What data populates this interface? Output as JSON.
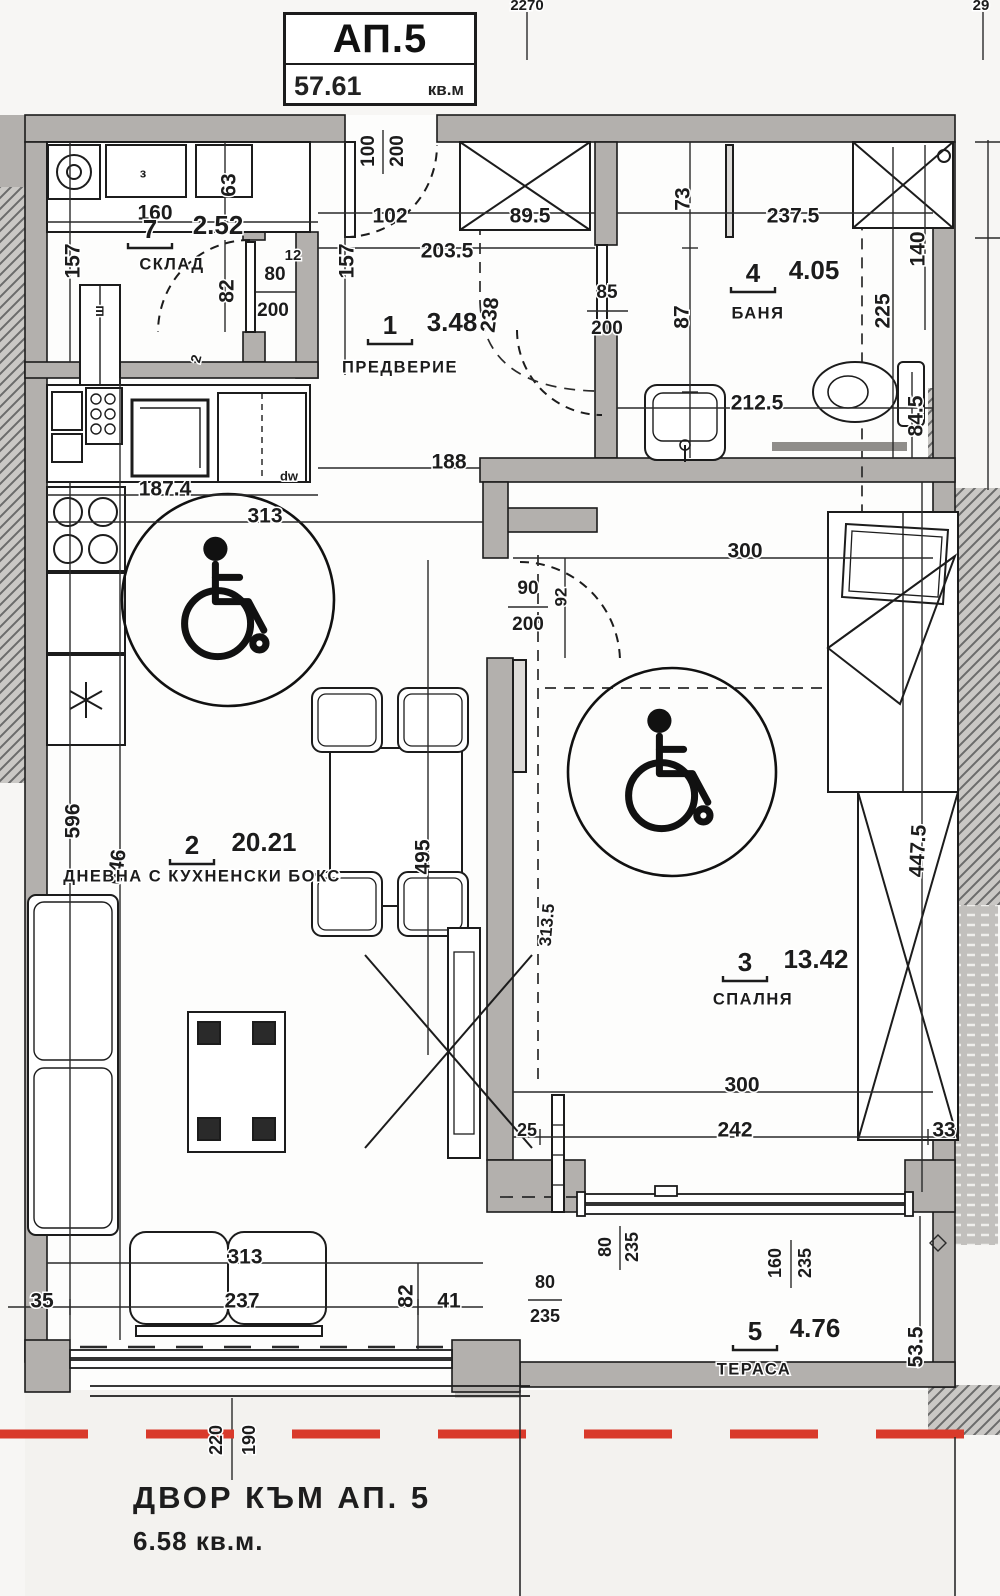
{
  "title_block": {
    "apartment": "АП.5",
    "area_value": "57.61",
    "area_unit": "кв.м"
  },
  "yard": {
    "line1": "ДВОР  КЪМ АП. 5",
    "line2": "6.58 кв.м."
  },
  "colors": {
    "wall": "#b3b0ad",
    "line": "#1c1c1c",
    "red_dashed": "#d93a2b",
    "hatch": "#6b6b6b"
  },
  "rooms": [
    {
      "num": "7",
      "area": "2.52",
      "name": "СКЛАД",
      "nx": 150,
      "ny": 231,
      "ax": 218,
      "ay": 227,
      "namex": 172,
      "namey": 265
    },
    {
      "num": "1",
      "area": "3.48",
      "name": "ПРЕДВЕРИЕ",
      "nx": 390,
      "ny": 327,
      "ax": 452,
      "ay": 324,
      "namex": 400,
      "namey": 368
    },
    {
      "num": "2",
      "area": "20.21",
      "name": "ДНЕВНА С КУХНЕНСКИ БОКС",
      "nx": 192,
      "ny": 847,
      "ax": 264,
      "ay": 844,
      "namex": 202,
      "namey": 877
    },
    {
      "num": "3",
      "area": "13.42",
      "name": "СПАЛНЯ",
      "nx": 745,
      "ny": 964,
      "ax": 816,
      "ay": 961,
      "namex": 753,
      "namey": 1000
    },
    {
      "num": "4",
      "area": "4.05",
      "name": "БАНЯ",
      "nx": 753,
      "ny": 275,
      "ax": 814,
      "ay": 272,
      "namex": 758,
      "namey": 314
    },
    {
      "num": "5",
      "area": "4.76",
      "name": "ТЕРАСА",
      "nx": 755,
      "ny": 1333,
      "ax": 815,
      "ay": 1330,
      "namex": 754,
      "namey": 1370
    }
  ],
  "dim_labels": [
    {
      "t": "160",
      "x": 155,
      "y": 214
    },
    {
      "t": "102",
      "x": 390,
      "y": 217
    },
    {
      "t": "89.5",
      "x": 530,
      "y": 217
    },
    {
      "t": "203.5",
      "x": 447,
      "y": 252
    },
    {
      "t": "157",
      "x": 74,
      "y": 261,
      "r": -90
    },
    {
      "t": "63",
      "x": 230,
      "y": 185,
      "r": -90
    },
    {
      "t": "82",
      "x": 228,
      "y": 291,
      "r": -90
    },
    {
      "t": "80",
      "x": 275,
      "y": 275,
      "s": 19
    },
    {
      "t": "200",
      "x": 273,
      "y": 311,
      "s": 19
    },
    {
      "t": "12",
      "x": 293,
      "y": 256,
      "s": 15
    },
    {
      "t": "100",
      "x": 369,
      "y": 151,
      "r": -90,
      "s": 19
    },
    {
      "t": "200",
      "x": 398,
      "y": 151,
      "r": -90,
      "s": 19
    },
    {
      "t": "157",
      "x": 348,
      "y": 261,
      "r": -90
    },
    {
      "t": "238",
      "x": 491,
      "y": 315,
      "r": -83
    },
    {
      "t": "237.5",
      "x": 793,
      "y": 217
    },
    {
      "t": "73",
      "x": 684,
      "y": 199,
      "r": -90
    },
    {
      "t": "87",
      "x": 683,
      "y": 317,
      "r": -90
    },
    {
      "t": "140",
      "x": 919,
      "y": 249,
      "r": -90
    },
    {
      "t": "225",
      "x": 884,
      "y": 311,
      "r": -90
    },
    {
      "t": "85",
      "x": 607,
      "y": 293,
      "s": 19
    },
    {
      "t": "200",
      "x": 607,
      "y": 329,
      "s": 19
    },
    {
      "t": "212.5",
      "x": 757,
      "y": 404
    },
    {
      "t": "84.5",
      "x": 917,
      "y": 416,
      "r": -90
    },
    {
      "t": "188",
      "x": 449,
      "y": 463
    },
    {
      "t": "187.4",
      "x": 165,
      "y": 490
    },
    {
      "t": "313",
      "x": 265,
      "y": 517
    },
    {
      "t": "300",
      "x": 745,
      "y": 552
    },
    {
      "t": "90",
      "x": 528,
      "y": 589,
      "s": 19
    },
    {
      "t": "200",
      "x": 528,
      "y": 625,
      "s": 19
    },
    {
      "t": "92",
      "x": 562,
      "y": 597,
      "r": -90,
      "s": 17
    },
    {
      "t": "596",
      "x": 74,
      "y": 821,
      "r": -90
    },
    {
      "t": "646",
      "x": 118,
      "y": 867,
      "r": -82
    },
    {
      "t": "495",
      "x": 424,
      "y": 857,
      "r": -90
    },
    {
      "t": "313.5",
      "x": 548,
      "y": 925,
      "r": -85,
      "s": 17
    },
    {
      "t": "447.5",
      "x": 919,
      "y": 851,
      "r": -87
    },
    {
      "t": "300",
      "x": 742,
      "y": 1086
    },
    {
      "t": "242",
      "x": 735,
      "y": 1131
    },
    {
      "t": "25",
      "x": 527,
      "y": 1131,
      "s": 18
    },
    {
      "t": "33",
      "x": 944,
      "y": 1131
    },
    {
      "t": "313",
      "x": 245,
      "y": 1258
    },
    {
      "t": "237",
      "x": 242,
      "y": 1302
    },
    {
      "t": "35",
      "x": 42,
      "y": 1302
    },
    {
      "t": "82",
      "x": 407,
      "y": 1296,
      "r": -90
    },
    {
      "t": "41",
      "x": 449,
      "y": 1302
    },
    {
      "t": "80",
      "x": 545,
      "y": 1283,
      "s": 18
    },
    {
      "t": "235",
      "x": 545,
      "y": 1317,
      "s": 18
    },
    {
      "t": "80",
      "x": 606,
      "y": 1247,
      "r": -90,
      "s": 18
    },
    {
      "t": "235",
      "x": 633,
      "y": 1247,
      "r": -90,
      "s": 18
    },
    {
      "t": "160",
      "x": 776,
      "y": 1263,
      "r": -90,
      "s": 18
    },
    {
      "t": "235",
      "x": 806,
      "y": 1263,
      "r": -90,
      "s": 18
    },
    {
      "t": "53.5",
      "x": 917,
      "y": 1347,
      "r": -90
    },
    {
      "t": "220",
      "x": 217,
      "y": 1440,
      "r": -90,
      "s": 18
    },
    {
      "t": "190",
      "x": 250,
      "y": 1440,
      "r": -90,
      "s": 18
    },
    {
      "t": "2270",
      "x": 527,
      "y": 6,
      "s": 15
    },
    {
      "t": "29",
      "x": 981,
      "y": 6,
      "s": 15
    }
  ],
  "small_labels": [
    {
      "t": "з",
      "x": 143,
      "y": 174,
      "s": 13
    },
    {
      "t": "ш",
      "x": 100,
      "y": 311,
      "r": -90,
      "s": 14
    },
    {
      "t": "dw",
      "x": 289,
      "y": 477,
      "s": 13
    },
    {
      "t": "2",
      "x": 197,
      "y": 359,
      "r": -75,
      "s": 14
    }
  ]
}
